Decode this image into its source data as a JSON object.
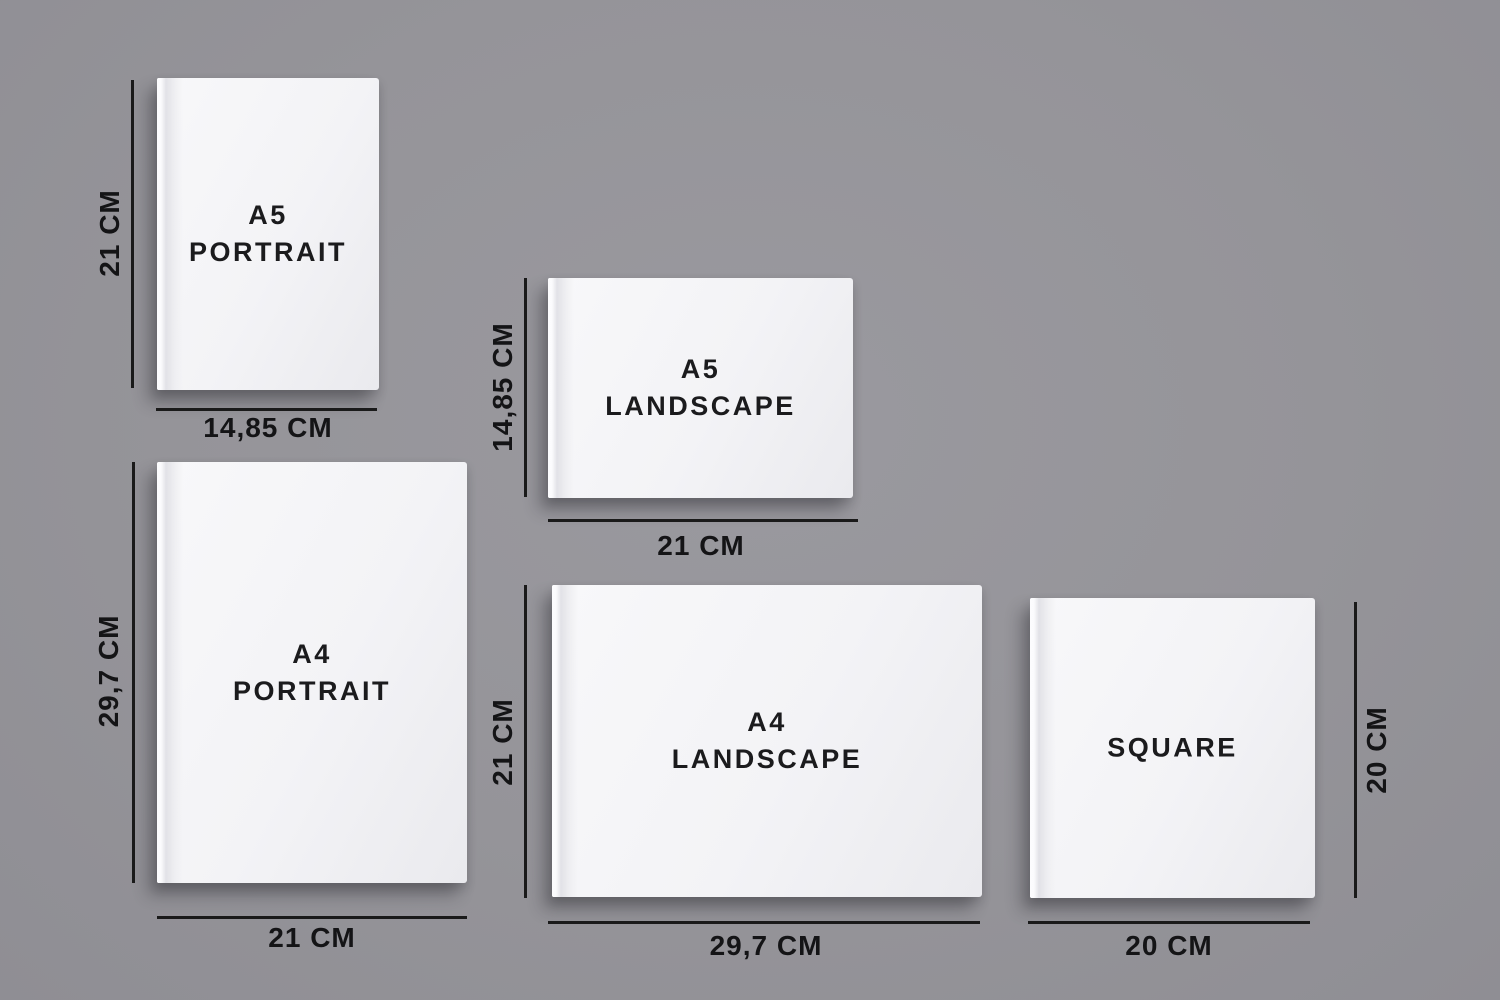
{
  "colors": {
    "background": "#95949a",
    "book_cover": "#f4f4f6",
    "dimension_line": "#1a1a1a",
    "text": "#1b1b1d"
  },
  "books": {
    "a5_portrait": {
      "title_line1": "A5",
      "title_line2": "PORTRAIT",
      "width_label": "14,85 CM",
      "height_label": "21 CM"
    },
    "a5_landscape": {
      "title_line1": "A5",
      "title_line2": "LANDSCAPE",
      "width_label": "21 CM",
      "height_label": "14,85 CM"
    },
    "a4_portrait": {
      "title_line1": "A4",
      "title_line2": "PORTRAIT",
      "width_label": "21 CM",
      "height_label": "29,7 CM"
    },
    "a4_landscape": {
      "title_line1": "A4",
      "title_line2": "LANDSCAPE",
      "width_label": "29,7 CM",
      "height_label": "21 CM"
    },
    "square": {
      "title_line1": "SQUARE",
      "width_label": "20 CM",
      "height_label": "20 CM"
    }
  }
}
